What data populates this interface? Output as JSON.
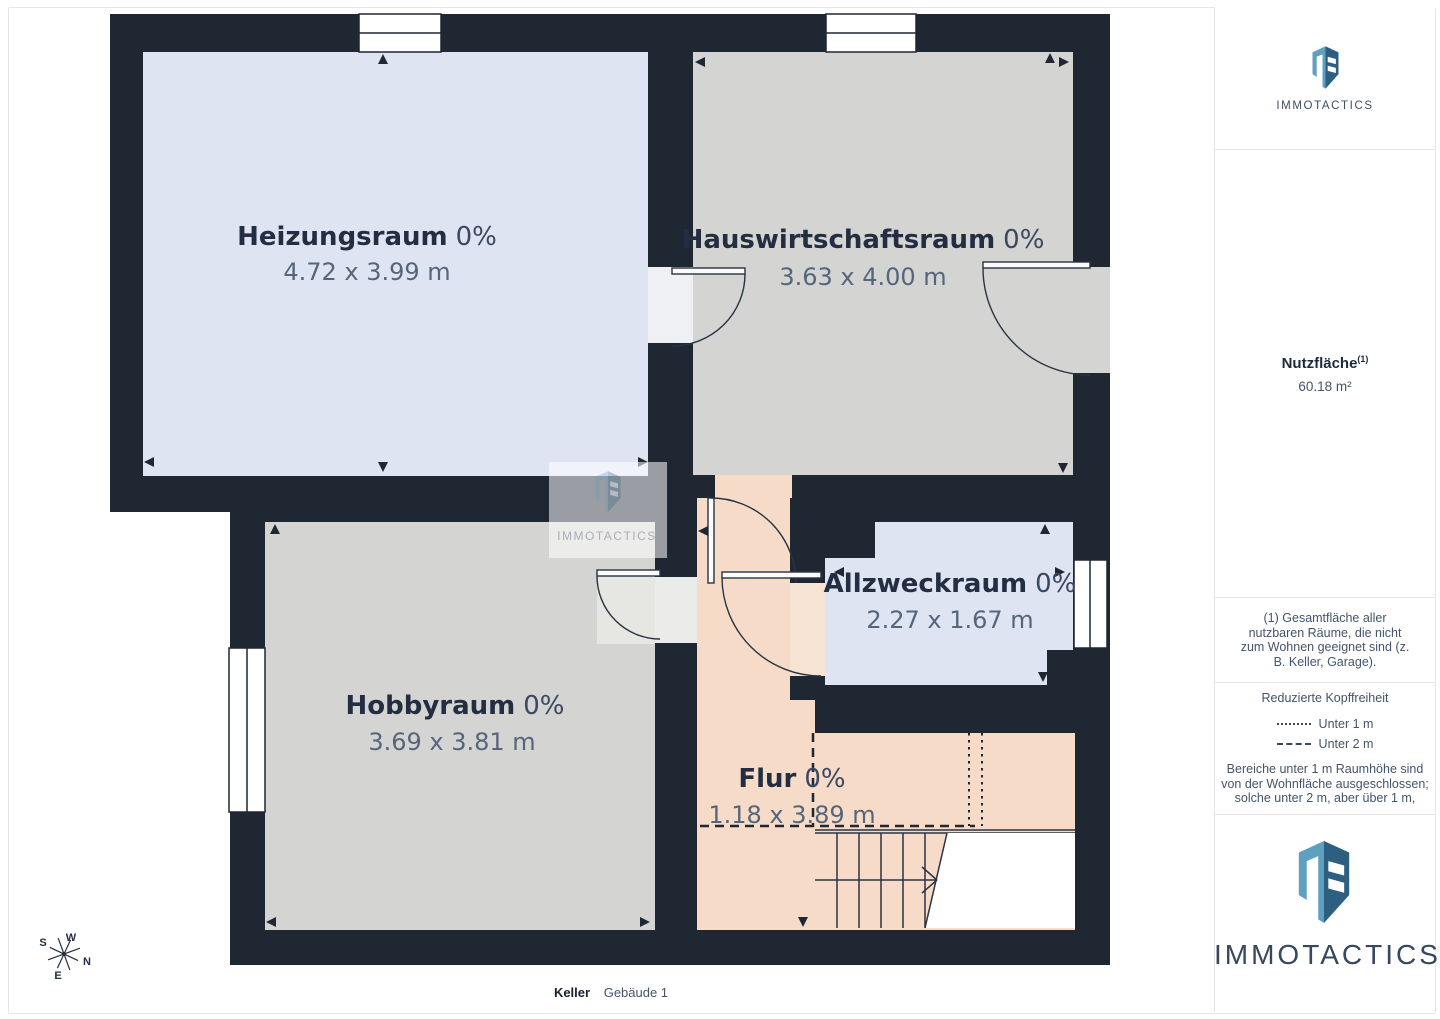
{
  "page": {
    "caption_primary": "Keller",
    "caption_secondary": "Gebäude 1"
  },
  "brand": {
    "name": "IMMOTACTICS",
    "logo_light_color": "#5f9fc0",
    "logo_dark_color": "#2e5f80"
  },
  "sidebar": {
    "stats": {
      "label": "Nutzfläche",
      "label_superscript": "(1)",
      "value": "60.18 m²"
    },
    "footnote": "(1) Gesamtfläche aller nutzbaren Räume, die nicht zum Wohnen geeignet sind (z. B. Keller, Garage).",
    "legend": {
      "title": "Reduzierte Kopffreiheit",
      "items": [
        {
          "style": "dotted",
          "label": "Unter 1 m"
        },
        {
          "style": "dashed",
          "label": "Unter 2 m"
        }
      ],
      "note_lines": [
        "Bereiche unter 1 m Raumhöhe sind",
        "von der Wohnfläche ausgeschlossen;",
        "solche unter 2 m, aber über 1 m,"
      ]
    }
  },
  "floorplan": {
    "rooms": [
      {
        "name": "Heizungsraum",
        "percent": "0%",
        "dimensions": "4.72 x 3.99 m"
      },
      {
        "name": "Hauswirtschaftsraum",
        "percent": "0%",
        "dimensions": "3.63 x 4.00 m"
      },
      {
        "name": "Hobbyraum",
        "percent": "0%",
        "dimensions": "3.69 x 3.81 m"
      },
      {
        "name": "Allzweckraum",
        "percent": "0%",
        "dimensions": "2.27 x 1.67 m"
      },
      {
        "name": "Flur",
        "percent": "0%",
        "dimensions": "1.18 x 3.89 m"
      }
    ],
    "colors": {
      "wall": "#1f2733",
      "room_gray": "#d4d4d2",
      "room_blue": "#dee4f1",
      "room_peach": "#f6dcc8"
    },
    "compass": {
      "n": "N",
      "s": "S",
      "e": "E",
      "w": "W"
    },
    "watermark": "IMMOTACTICS"
  }
}
